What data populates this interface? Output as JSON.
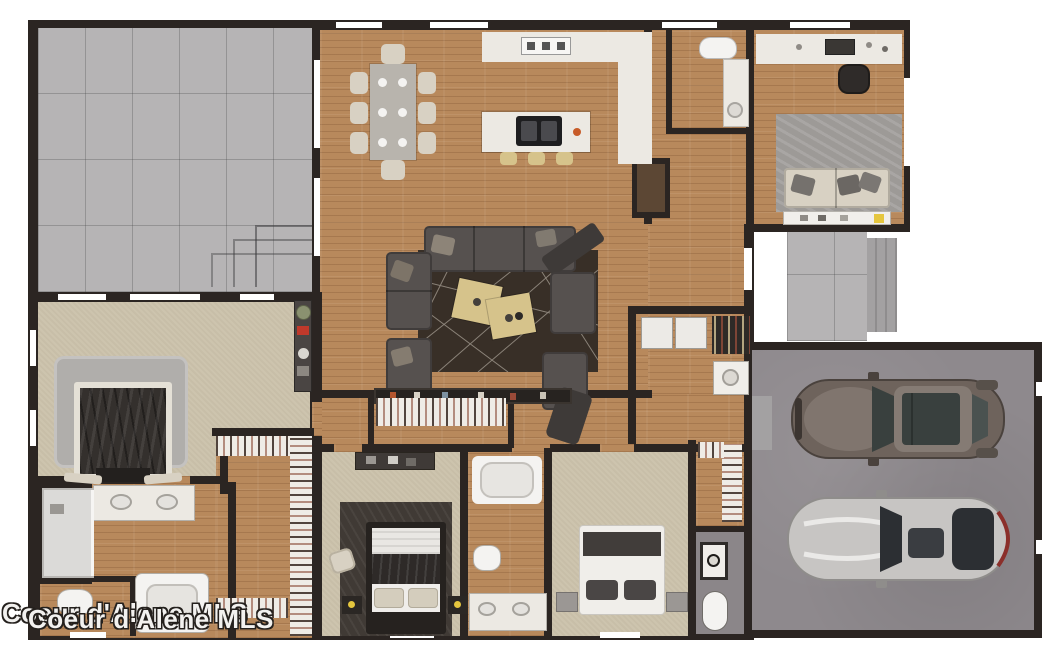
{
  "watermark": {
    "line1": "Coeur d'Alene MLS",
    "line2": "Coeur d'Alene MLS"
  },
  "colors": {
    "wall": "#2b2522",
    "wood": "#b8895c",
    "wood-dark": "#5c4734",
    "carpet": "#cdc4ae",
    "concrete": "#b6b4b5",
    "concrete-step": "#a3a1a2",
    "garage": "#8e898d",
    "counter": "#ece9e3",
    "shower": "#dbdad8",
    "rug-dark": "#382f27",
    "rug-gray": "#9d9a97",
    "rug-bed2": "#403a35",
    "sofa": "#56514f",
    "sofa-dark": "#3e3a38",
    "cream": "#d8d1c3",
    "table-gray": "#b8b4ad",
    "coffee-table": "#d6c38b",
    "sink-dark": "#1e1e20",
    "accent-red": "#c0392b",
    "accent-orange": "#c75b28",
    "accent-yellow": "#e5c63e",
    "plant-green": "#8a9170",
    "car1-body": "#6e635c",
    "car1-roof": "#857b74",
    "car-glass": "#39403e",
    "car2-body": "#c7c5c3",
    "car2-glass": "#2c2f33",
    "bath3-floor": "#8b8689",
    "fixture-white": "#f4f3f1"
  }
}
